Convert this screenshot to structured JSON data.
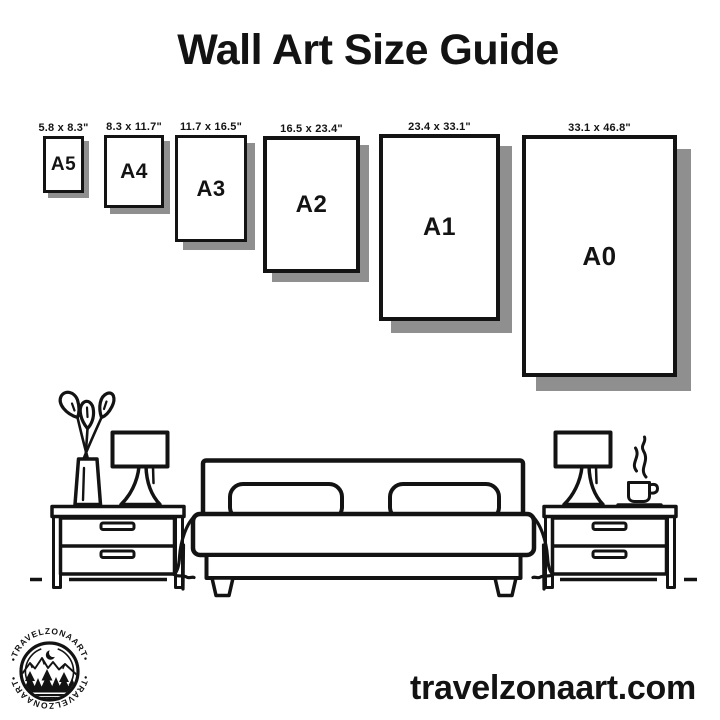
{
  "title": "Wall Art Size Guide",
  "sizes": [
    {
      "code": "A5",
      "dims": "5.8 x 8.3\""
    },
    {
      "code": "A4",
      "dims": "8.3 x 11.7\""
    },
    {
      "code": "A3",
      "dims": "11.7 x 16.5\""
    },
    {
      "code": "A2",
      "dims": "16.5 x 23.4\""
    },
    {
      "code": "A1",
      "dims": "23.4 x 33.1\""
    },
    {
      "code": "A0",
      "dims": "33.1 x 46.8\""
    }
  ],
  "logo": {
    "arc_text": "•TRAVELZONAART•"
  },
  "footer": {
    "website": "travelzonaart.com"
  },
  "colors": {
    "ink": "#131313",
    "shadow": "#8f8f8f",
    "background": "#ffffff"
  }
}
